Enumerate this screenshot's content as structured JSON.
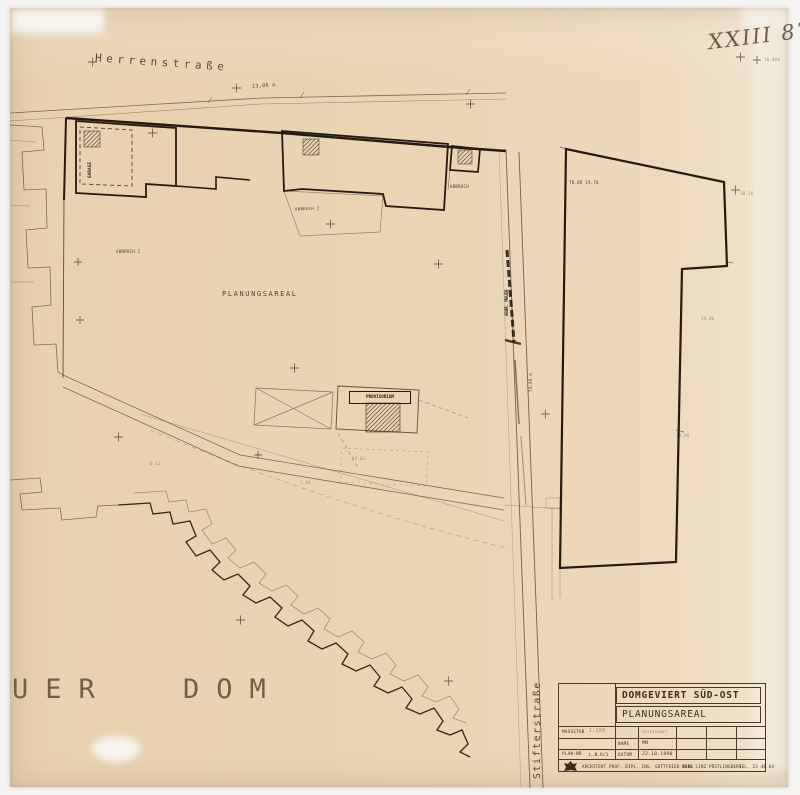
{
  "sheet": {
    "archive_number": "XXIII 87",
    "elevation_note": "10.860"
  },
  "streets": {
    "herrenstrasse": "Herrenstraße",
    "stifterstrasse": "Stifterstraße"
  },
  "labels": {
    "planungsareal": "PLANUNGSAREAL",
    "abbruch_1": "ABBRUCH 1",
    "abbruch_2": "ABBRUCH 2",
    "abbruch": "ABBRUCH",
    "provisorium": "PROVISORIUM",
    "garage": "GARAGE",
    "mauer": "ABBR. MAUER",
    "dom": "UER DOM"
  },
  "dimensions": {
    "top_width": "13,00 m",
    "street_length": "74,00 m",
    "tr_bo_top": "TR.BÖ 7,00",
    "tr_bo_right": "TR.BÖ 19,76",
    "level_a": "19.80",
    "level_b": "13.86",
    "level_c": "10.26",
    "mark_a": "14.01",
    "mark_b": "7.44",
    "mark_c": "6.12"
  },
  "title_block": {
    "title": "DOMGEVIERT SÜD-OST",
    "subtitle": "PLANUNGSAREAL",
    "massstab_label": "MASSSTAB",
    "massstab_value": "1:200",
    "plan_nr_label": "PLAN-NR",
    "plan_nr_value": "L.N.R/1",
    "gezeichnet_label": "GEZEICHNET",
    "name_label": "NAME",
    "name_value": "MN",
    "datum_label": "DATUM",
    "datum_value": "22.10.1990",
    "architect": "ARCHITEKT PROF. DIPL. ING. GOTTFRIED NOBL",
    "address": "4040 LINZ-PÖSTLINGBERG",
    "phone": "TEL. 23 46 84"
  }
}
